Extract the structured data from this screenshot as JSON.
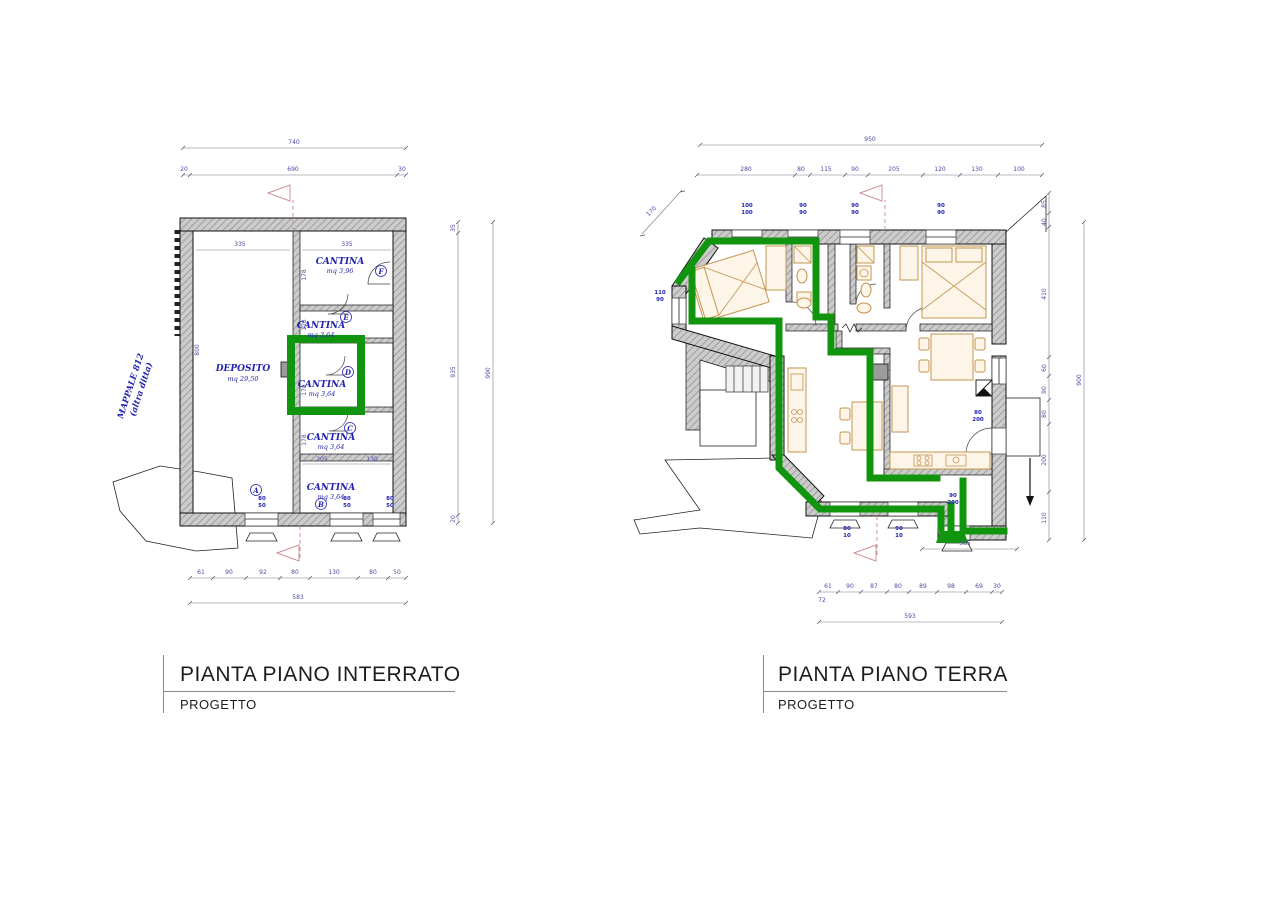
{
  "colors": {
    "highlight_green": "#12950e",
    "annotation_blue": "#2323b0",
    "wall_gray": "#c9c9c9",
    "furniture_tan": "#c49452",
    "section_pink": "#cc9494"
  },
  "basement": {
    "title": "PIANTA PIANO INTERRATO",
    "subtitle": "PROGETTO",
    "mappale_line1": "MAPPALE 812",
    "mappale_line2": "(altra ditta)",
    "rooms": {
      "deposito": {
        "name": "DEPOSITO",
        "area": "mq 29,50"
      },
      "cantina_f": {
        "name": "CANTINA",
        "area": "mq 3,96",
        "tag": "F"
      },
      "cantina_e": {
        "name": "CANTINA",
        "area": "mq 3,64",
        "tag": "E"
      },
      "cantina_d": {
        "name": "CANTINA",
        "area": "mq 3,64",
        "tag": "D"
      },
      "cantina_c": {
        "name": "CANTINA",
        "area": "mq 3,64",
        "tag": "C"
      },
      "cantina_b": {
        "name": "CANTINA",
        "area": "mq 3,64",
        "tag": "B"
      }
    },
    "marker_a": "A",
    "dims": {
      "top_total": "740",
      "top_chain": [
        "20",
        "690",
        "30"
      ],
      "width_left": "335",
      "width_right": "335",
      "right_chain": [
        "35",
        "935",
        "20"
      ],
      "right_total": "990",
      "left_height": "800",
      "seg_heights": [
        "178",
        "178",
        "178",
        "178"
      ],
      "row_c": [
        "205",
        "130"
      ],
      "bottom_chain": [
        "61",
        "90",
        "92",
        "80",
        "130",
        "80",
        "50"
      ],
      "bottom_total": "583"
    },
    "window_labels": [
      {
        "a": "80",
        "b": "50"
      },
      {
        "a": "80",
        "b": "50"
      },
      {
        "a": "80",
        "b": "50"
      }
    ]
  },
  "ground": {
    "title": "PIANTA PIANO TERRA",
    "subtitle": "PROGETTO",
    "dims": {
      "top_total": "950",
      "top_chain": [
        "280",
        "80",
        "115",
        "90",
        "205",
        "120",
        "130",
        "100"
      ],
      "right_chain": [
        "85",
        "40",
        "410",
        "60",
        "90",
        "80",
        "200",
        "110"
      ],
      "right_total": "900",
      "bottom_chain": [
        "61",
        "90",
        "87",
        "80",
        "89",
        "98",
        "69",
        "30"
      ],
      "bottom_pre": "72",
      "bottom_total": "593",
      "entry_width": "385",
      "diag": "170"
    },
    "labels": {
      "top": [
        {
          "a": "100",
          "b": "100"
        },
        {
          "a": "90",
          "b": "90"
        },
        {
          "a": "90",
          "b": "90"
        },
        {
          "a": "90",
          "b": "90"
        }
      ],
      "left": {
        "a": "110",
        "b": "90"
      },
      "right_door": {
        "a": "80",
        "b": "200"
      },
      "entrance": {
        "a": "90",
        "b": "200"
      },
      "bottom": [
        {
          "a": "80",
          "b": "10"
        },
        {
          "a": "90",
          "b": "10"
        }
      ]
    }
  }
}
